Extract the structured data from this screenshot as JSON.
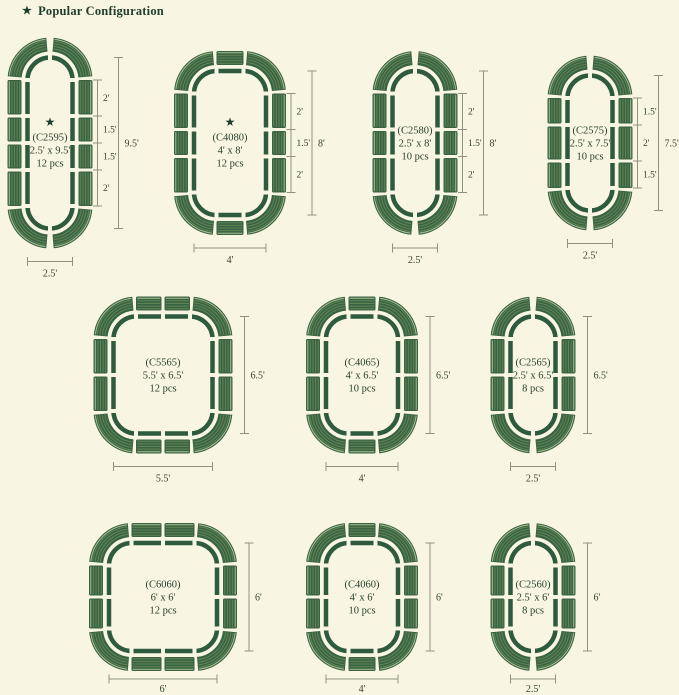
{
  "header": {
    "star_icon": "★",
    "title": "Popular Configuration"
  },
  "colors": {
    "background": "#f8f5e2",
    "outline_green": "#2e5a3e",
    "panel_green": "#3a6344",
    "panel_stripe_light": "#5f8455",
    "panel_stripe_pale": "#a9bf92",
    "text_dark": "#27402d",
    "dim_line": "#8e9380",
    "dim_text": "#32432f",
    "header_text": "#1e3c2c"
  },
  "configs": [
    {
      "code": "(C2595)",
      "size": "2.5' x 9.5'",
      "pcs": "12 pcs",
      "star": true,
      "width_ft": 2.5,
      "height_ft": 9.5,
      "side_segments_ft": [
        2,
        1.5,
        1.5,
        2
      ],
      "end_segments_ft": [],
      "segment_labels": [
        "2'",
        "1.5'",
        "1.5'",
        "2'"
      ],
      "height_label": "9.5'",
      "width_label": "2.5'"
    },
    {
      "code": "(C4080)",
      "size": "4' x 8'",
      "pcs": "12 pcs",
      "star": true,
      "width_ft": 4,
      "height_ft": 8,
      "side_segments_ft": [
        2,
        1.5,
        2
      ],
      "end_segments_ft": [
        1.5
      ],
      "segment_labels": [
        "2'",
        "1.5'",
        "2'"
      ],
      "height_label": "8'",
      "width_label": "4'"
    },
    {
      "code": "(C2580)",
      "size": "2.5' x 8'",
      "pcs": "10 pcs",
      "star": false,
      "width_ft": 2.5,
      "height_ft": 8,
      "side_segments_ft": [
        2,
        1.5,
        2
      ],
      "end_segments_ft": [],
      "segment_labels": [
        "2'",
        "1.5'",
        "2'"
      ],
      "height_label": "8'",
      "width_label": "2.5'"
    },
    {
      "code": "(C2575)",
      "size": "2.5' x 7.5'",
      "pcs": "10 pcs",
      "star": false,
      "width_ft": 2.5,
      "height_ft": 7.5,
      "side_segments_ft": [
        1.5,
        2,
        1.5
      ],
      "end_segments_ft": [],
      "segment_labels": [
        "1.5'",
        "2'",
        "1.5'"
      ],
      "height_label": "7.5'",
      "width_label": "2.5'"
    },
    {
      "code": "(C5565)",
      "size": "5.5' x 6.5'",
      "pcs": "12 pcs",
      "star": false,
      "width_ft": 5.5,
      "height_ft": 6.5,
      "side_segments_ft": [
        2,
        2
      ],
      "end_segments_ft": [
        1.5,
        1.5
      ],
      "segment_labels": [],
      "height_label": "6.5'",
      "width_label": "5.5'"
    },
    {
      "code": "(C4065)",
      "size": "4' x 6.5'",
      "pcs": "10 pcs",
      "star": false,
      "width_ft": 4,
      "height_ft": 6.5,
      "side_segments_ft": [
        2,
        2
      ],
      "end_segments_ft": [
        1.5
      ],
      "segment_labels": [],
      "height_label": "6.5'",
      "width_label": "4'"
    },
    {
      "code": "(C2565)",
      "size": "2.5' x 6.5'",
      "pcs": "8 pcs",
      "star": false,
      "width_ft": 2.5,
      "height_ft": 6.5,
      "side_segments_ft": [
        2,
        2
      ],
      "end_segments_ft": [],
      "segment_labels": [],
      "height_label": "6.5'",
      "width_label": "2.5'"
    },
    {
      "code": "(C6060)",
      "size": "6' x 6'",
      "pcs": "12 pcs",
      "star": false,
      "width_ft": 6,
      "height_ft": 6,
      "side_segments_ft": [
        1.75,
        1.75
      ],
      "end_segments_ft": [
        1.75,
        1.75
      ],
      "segment_labels": [],
      "height_label": "6'",
      "width_label": "6'"
    },
    {
      "code": "(C4060)",
      "size": "4' x 6'",
      "pcs": "10 pcs",
      "star": false,
      "width_ft": 4,
      "height_ft": 6,
      "side_segments_ft": [
        1.75,
        1.75
      ],
      "end_segments_ft": [
        1.5
      ],
      "segment_labels": [],
      "height_label": "6'",
      "width_label": "4'"
    },
    {
      "code": "(C2560)",
      "size": "2.5' x 6'",
      "pcs": "8 pcs",
      "star": false,
      "width_ft": 2.5,
      "height_ft": 6,
      "side_segments_ft": [
        1.75,
        1.75
      ],
      "end_segments_ft": [],
      "segment_labels": [],
      "height_label": "6'",
      "width_label": "2.5'"
    }
  ]
}
